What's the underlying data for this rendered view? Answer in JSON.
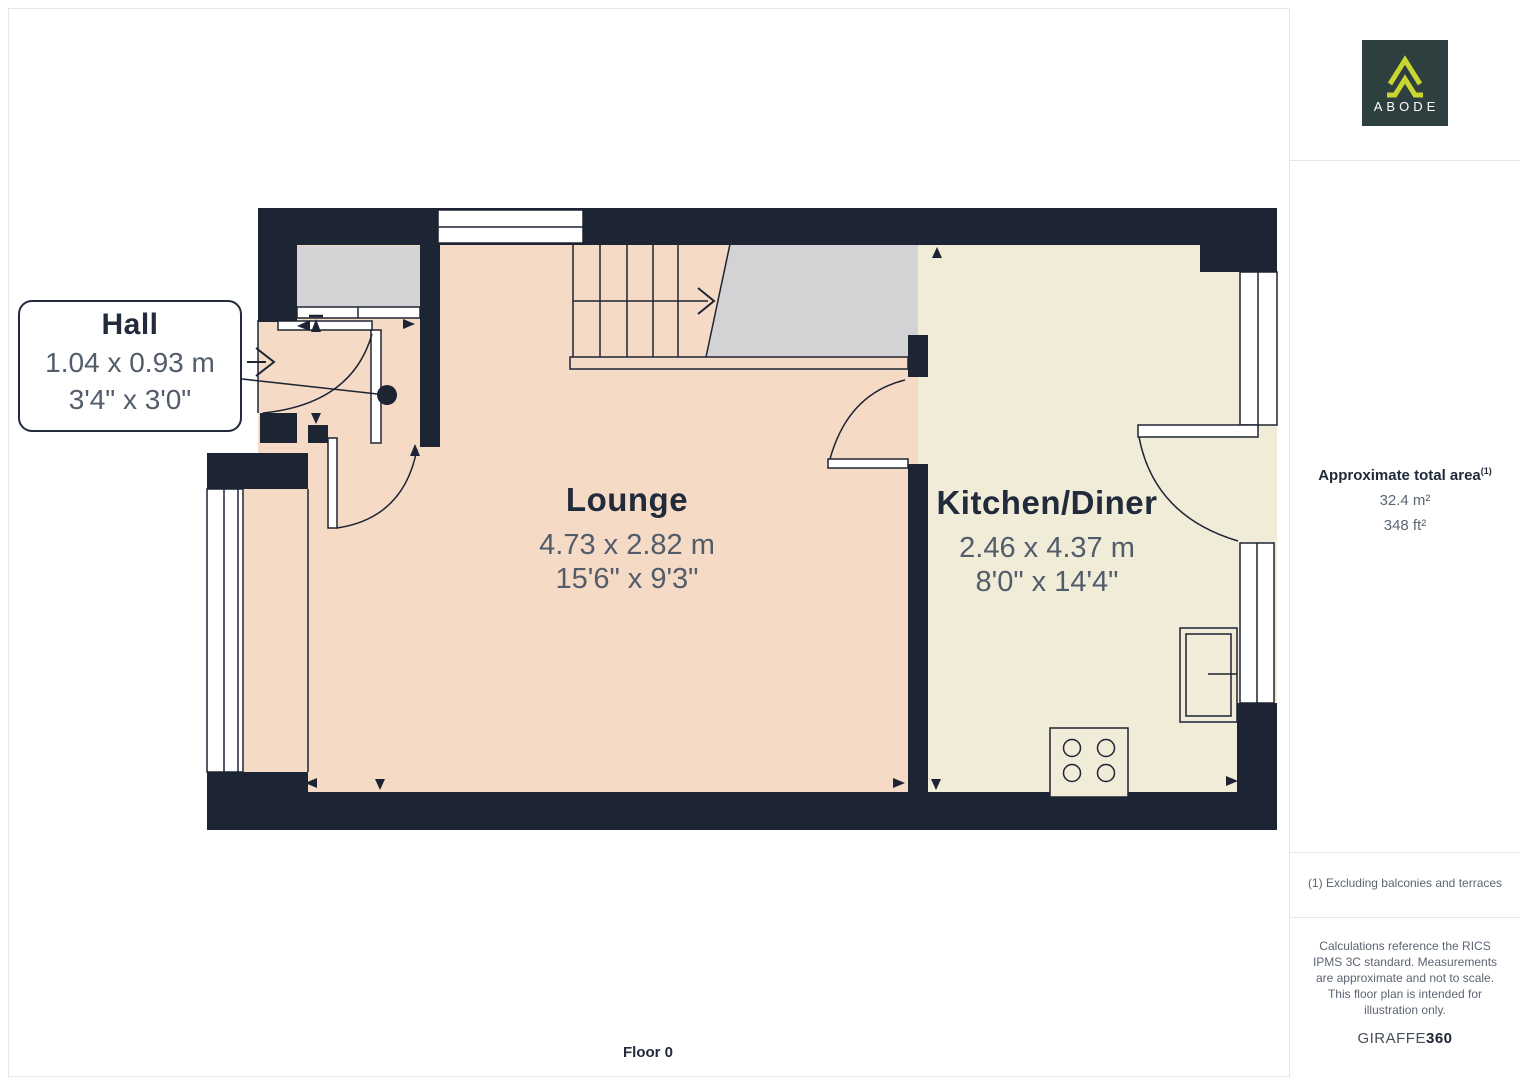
{
  "floorplan": {
    "floor_label": "Floor 0",
    "rooms": [
      {
        "name": "Hall",
        "dims_m": "1.04 x 0.93 m",
        "dims_ft": "3'4\" x 3'0\""
      },
      {
        "name": "Lounge",
        "dims_m": "4.73 x 2.82 m",
        "dims_ft": "15'6\" x 9'3\""
      },
      {
        "name": "Kitchen/Diner",
        "dims_m": "2.46 x 4.37 m",
        "dims_ft": "8'0\" x 14'4\""
      }
    ],
    "colors": {
      "wall": "#1d2433",
      "lounge_floor": "#f5dac6",
      "kitchen_floor": "#f1ecd8",
      "stairs_gray": "#d3d3d6",
      "room_name_text": "#222b3b",
      "dimension_text": "#525c6b"
    }
  },
  "sidebar": {
    "logo_text": "ABODE",
    "logo_bg": "#2d3f3f",
    "logo_accent": "#c9d630",
    "area_title": "Approximate total area",
    "area_superscript": "(1)",
    "area_m2": "32.4 m²",
    "area_ft2": "348 ft²",
    "footnote": "(1) Excluding balconies and terraces",
    "disclaimer": "Calculations reference the RICS IPMS 3C standard. Measurements are approximate and not to scale. This floor plan is intended for illustration only.",
    "brand_regular": "GIRAFFE",
    "brand_bold": "360"
  }
}
